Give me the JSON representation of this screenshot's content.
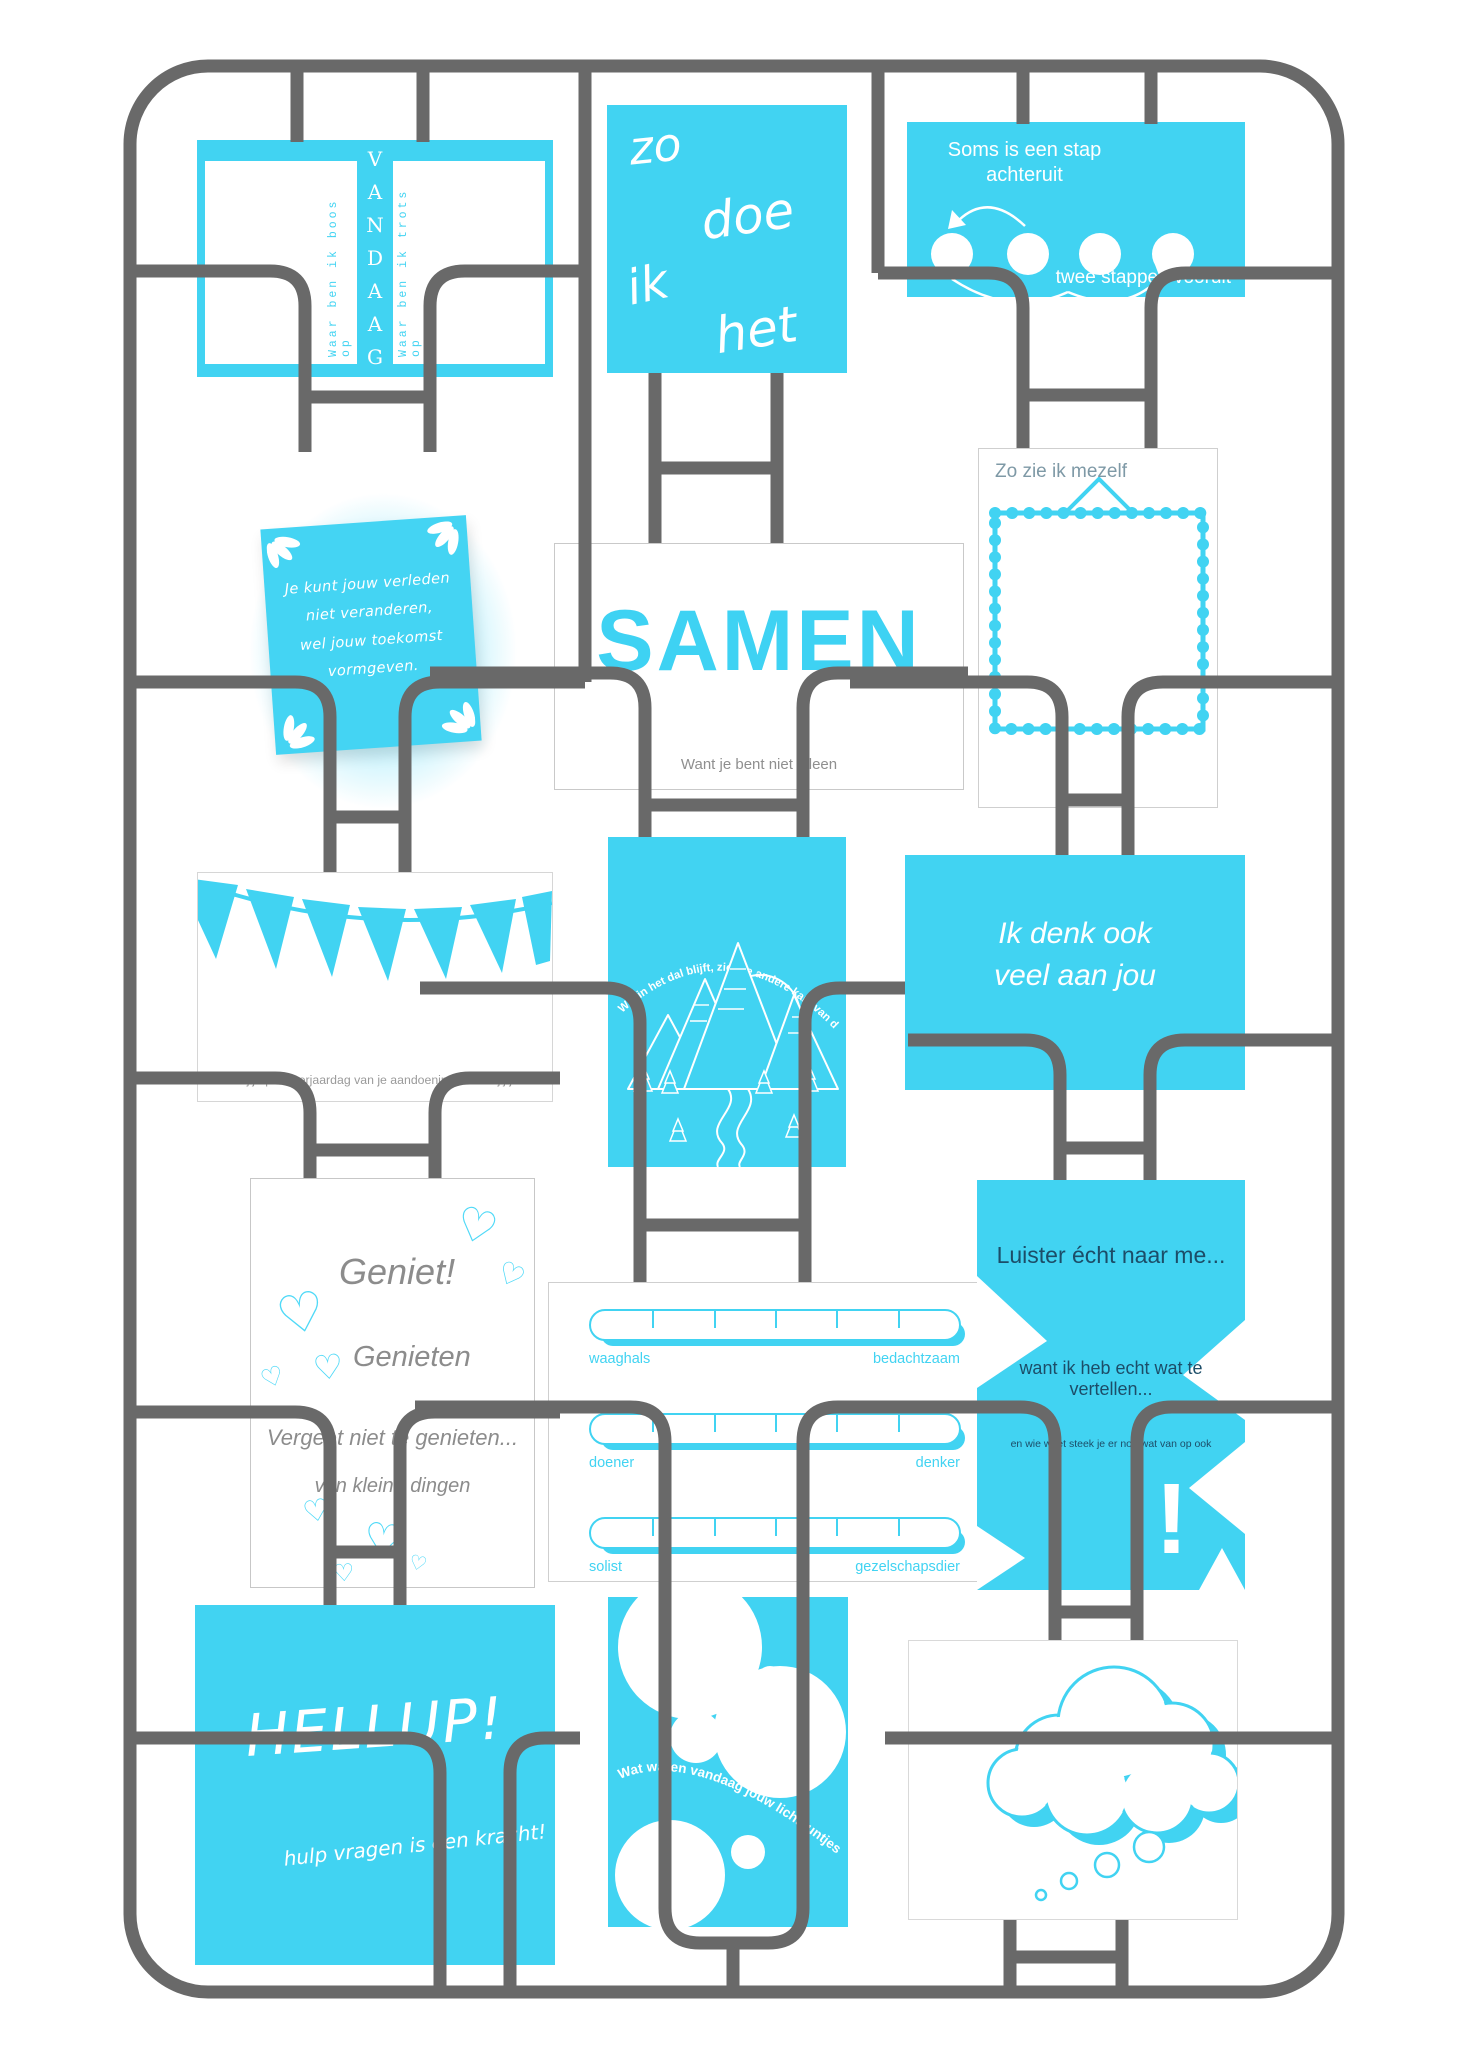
{
  "poster": {
    "colors": {
      "cyan": "#41d3f2",
      "pipe": "#696969",
      "dark_text": "#1c4d68",
      "gray_text": "#8f8f8f"
    },
    "icons": {
      "heart": "♡"
    },
    "cards": {
      "vandaag": {
        "title": "VANDAAG",
        "left_label": "Waar ben ik boos op",
        "right_label": "Waar ben ik trots op"
      },
      "zodoe": {
        "words": [
          "zo",
          "doe",
          "ik",
          "het"
        ]
      },
      "soms": {
        "line1": "Soms is een stap",
        "line2": "achteruit",
        "bottom": "twee stappen vooruit"
      },
      "sticky": {
        "lines": [
          "Je kunt jouw verleden",
          "niet veranderen,",
          "wel jouw toekomst",
          "vormgeven."
        ]
      },
      "samen": {
        "title": "SAMEN",
        "subtitle": "Want je bent niet alleen"
      },
      "mezelf": {
        "title": "Zo zie ik mezelf"
      },
      "bunting": {
        "caption": "Wat doe jij op de verjaardag van je aandoening? Stuur jij jezelf een kaartje?"
      },
      "mountain": {
        "arc_text": "Wie in het dal blijft, ziet de andere kant van de berg niet"
      },
      "denk": {
        "line1": "Ik denk ook",
        "line2": "veel aan jou"
      },
      "geniet": {
        "title": "Geniet!",
        "word": "Genieten",
        "line1": "Vergeet niet te genieten...",
        "line2": "van kleine dingen"
      },
      "sliders": {
        "rows": [
          {
            "left": "waaghals",
            "right": "bedachtzaam"
          },
          {
            "left": "doener",
            "right": "denker"
          },
          {
            "left": "solist",
            "right": "gezelschapsdier"
          }
        ]
      },
      "luister": {
        "line1": "Luister écht naar me...",
        "line2": "want ik heb echt wat te vertellen...",
        "line3": "en wie weet steek je er nog wat van op ook",
        "mark": "!"
      },
      "hellup": {
        "title": "HELLUP!",
        "subtitle": "hulp vragen is een kracht!"
      },
      "bubbles": {
        "arc_text": "Wat waren vandaag jouw lichtpuntjes?"
      }
    }
  }
}
